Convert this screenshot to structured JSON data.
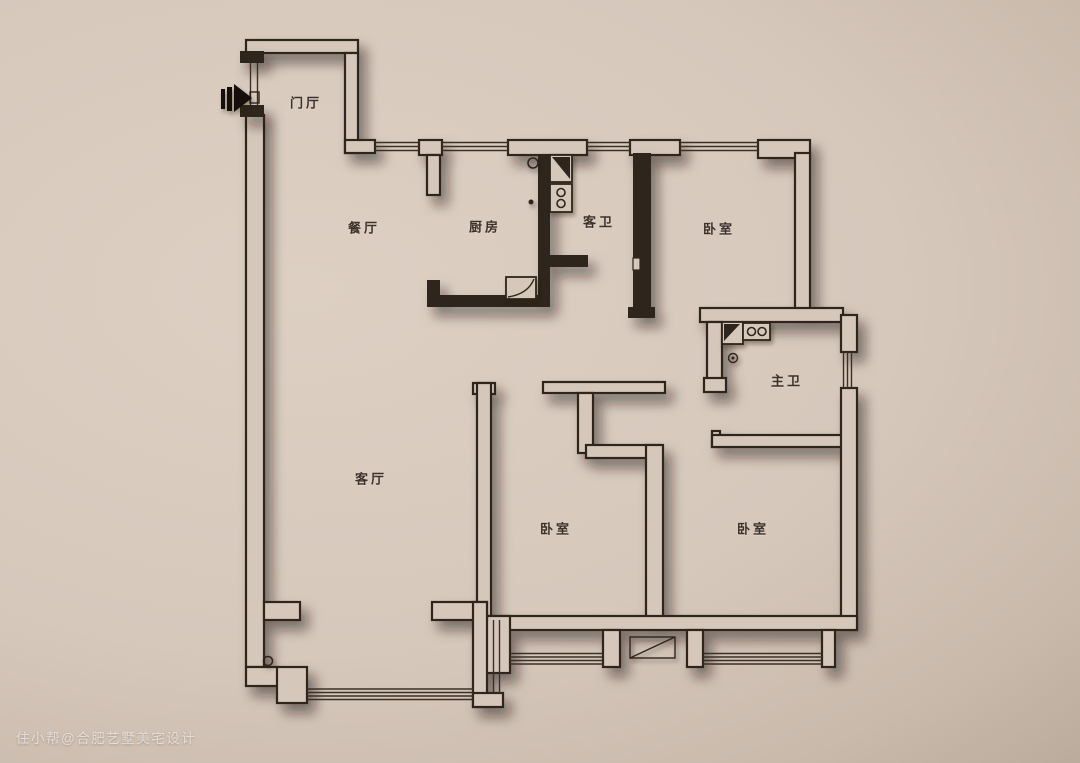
{
  "title": "residential-floor-plan",
  "palette": {
    "background_light": "#ddd0c3",
    "background_dark": "#94857a",
    "wall_fill": "#d5c7ba",
    "wall_line": "#2e251c",
    "shadow": "rgba(35,24,15,0.5)",
    "watermark_color": "rgba(255,255,255,0.58)"
  },
  "rooms": [
    {
      "id": "entry-hall",
      "label": "门厅"
    },
    {
      "id": "dining-room",
      "label": "餐厅"
    },
    {
      "id": "kitchen",
      "label": "厨房"
    },
    {
      "id": "guest-bathroom",
      "label": "客卫"
    },
    {
      "id": "bedroom-top-right",
      "label": "卧室"
    },
    {
      "id": "master-bathroom",
      "label": "主卫"
    },
    {
      "id": "living-room",
      "label": "客厅"
    },
    {
      "id": "bedroom-bottom-mid",
      "label": "卧室"
    },
    {
      "id": "bedroom-bottom-right",
      "label": "卧室"
    }
  ],
  "icons": [
    {
      "name": "entrance-arrow-icon",
      "meaning": "unit entry direction"
    },
    {
      "name": "toilet-icon",
      "meaning": "toilet fixture"
    },
    {
      "name": "basin-icon",
      "meaning": "wash basin fixture"
    },
    {
      "name": "kitchen-sink-icon",
      "meaning": "kitchen sink fixture"
    },
    {
      "name": "floor-drain-icon",
      "meaning": "floor drain"
    },
    {
      "name": "ac-platform-icon",
      "meaning": "air-conditioner platform"
    }
  ],
  "watermark": {
    "text": "住小帮@合肥艺墅美宅设计"
  }
}
